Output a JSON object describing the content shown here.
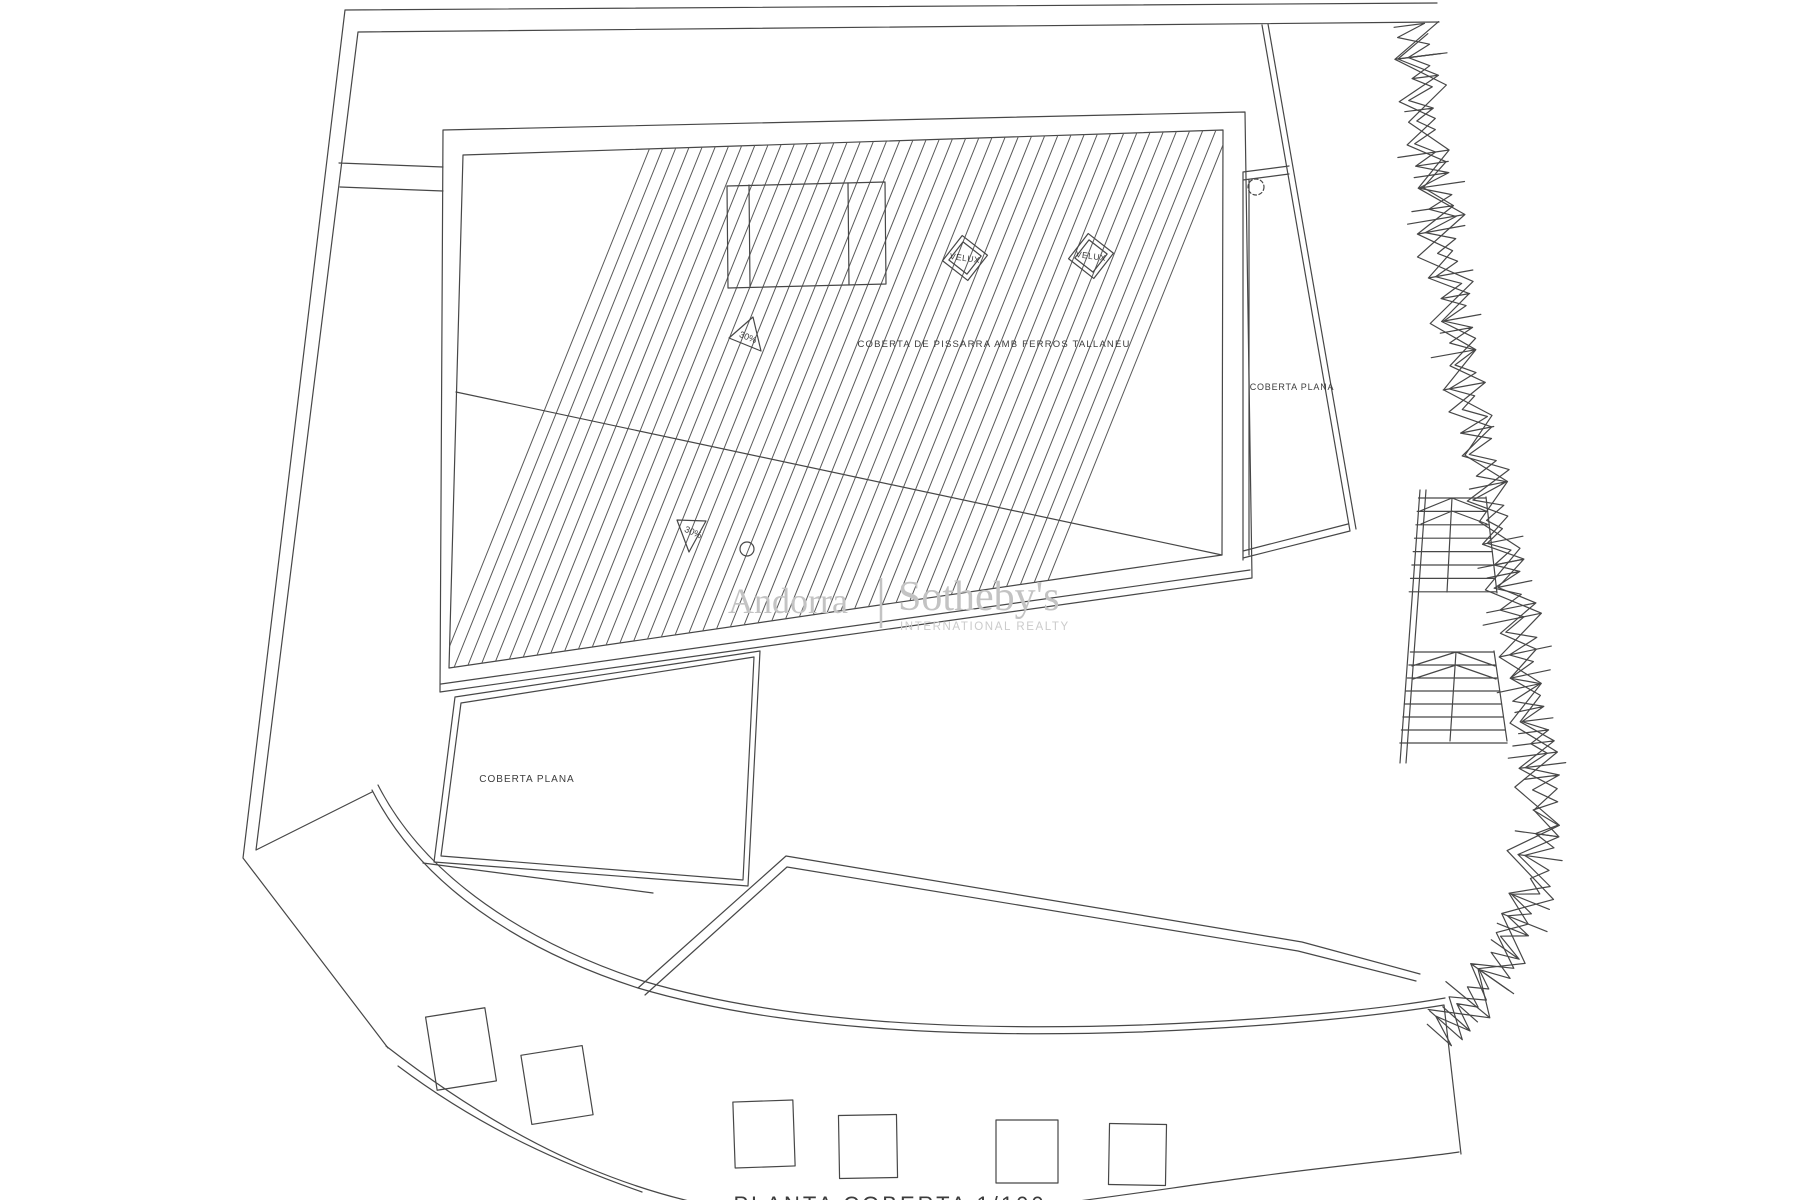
{
  "drawing": {
    "main_roof_label": "COBERTA DE PISSARRA AMB FERROS TALLANEU",
    "left_flat_roof_label": "COBERTA PLANA",
    "right_flat_roof_label": "COBERTA PLANA",
    "skylight_label_1": "VELUX",
    "skylight_label_2": "VELUX",
    "slope_label_upper": "30%",
    "slope_label_lower": "30%",
    "caption_cropped": "PLANTA COBERTA   1/100"
  },
  "watermark": {
    "left": "Andorra",
    "right": "Sotheby's",
    "subtitle": "INTERNATIONAL REALTY",
    "color": "#c3c3c3"
  },
  "colors": {
    "ink": "#474747",
    "paper": "#ffffff",
    "hatch": "#5a5a5a"
  }
}
